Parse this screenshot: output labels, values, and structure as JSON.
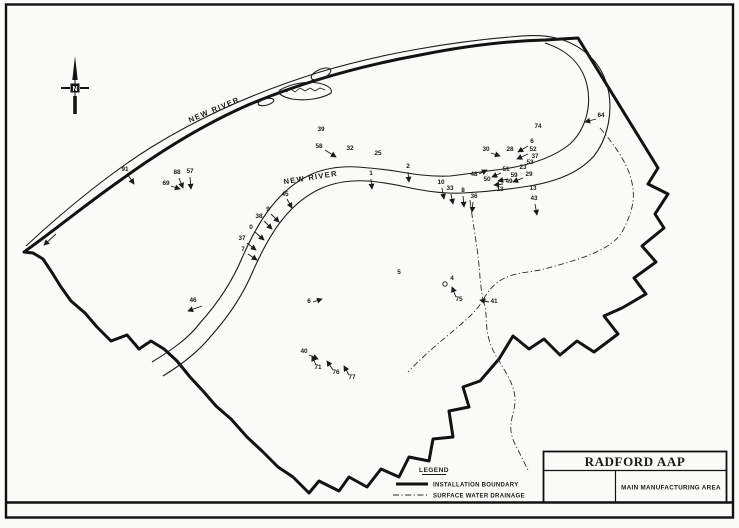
{
  "page": {
    "bg": "#fafaf8",
    "ink": "#1b1b1b"
  },
  "north_arrow": {
    "label": "N"
  },
  "river_labels": [
    {
      "text": "NEW RIVER",
      "x": 215,
      "y": 112,
      "rotate": -23
    },
    {
      "text": "NEW RIVER",
      "x": 311,
      "y": 180,
      "rotate": -9
    }
  ],
  "legend": {
    "heading": "LEGEND",
    "items": [
      {
        "label": "INSTALLATION BOUNDARY",
        "style": "boundary"
      },
      {
        "label": "SURFACE WATER DRAINAGE",
        "style": "drainage"
      }
    ]
  },
  "title_block": {
    "title": "RADFORD AAP",
    "subtitle": "MAIN MANUFACTURING AREA"
  },
  "sites": [
    {
      "n": "91",
      "x": 125,
      "y": 171,
      "a": [
        128,
        175,
        134,
        184
      ]
    },
    {
      "n": "69",
      "x": 166,
      "y": 185,
      "a": [
        171,
        186,
        180,
        189
      ]
    },
    {
      "n": "88",
      "x": 177,
      "y": 174,
      "a": [
        179,
        178,
        183,
        188
      ]
    },
    {
      "n": "57",
      "x": 190,
      "y": 173,
      "a": [
        190,
        177,
        191,
        189
      ]
    },
    {
      "n": "39",
      "x": 321,
      "y": 131
    },
    {
      "n": "58",
      "x": 319,
      "y": 148,
      "a": [
        325,
        150,
        336,
        157
      ]
    },
    {
      "n": "32",
      "x": 350,
      "y": 150
    },
    {
      "n": "25",
      "x": 378,
      "y": 155
    },
    {
      "n": "45",
      "x": 285,
      "y": 196,
      "a": [
        287,
        199,
        292,
        208
      ]
    },
    {
      "n": "9",
      "x": 268,
      "y": 211,
      "a": [
        271,
        214,
        279,
        222
      ]
    },
    {
      "n": "38",
      "x": 259,
      "y": 218,
      "a": [
        264,
        221,
        272,
        229
      ]
    },
    {
      "n": "0",
      "x": 251,
      "y": 229,
      "a": [
        255,
        232,
        264,
        240
      ]
    },
    {
      "n": "37",
      "x": 242,
      "y": 240,
      "a": [
        247,
        243,
        256,
        250
      ]
    },
    {
      "n": "7",
      "x": 243,
      "y": 251,
      "a": [
        248,
        254,
        257,
        260
      ]
    },
    {
      "n": "1",
      "x": 371,
      "y": 175,
      "a": [
        371,
        179,
        372,
        189
      ]
    },
    {
      "n": "2",
      "x": 408,
      "y": 168,
      "a": [
        408,
        172,
        409,
        182
      ]
    },
    {
      "n": "10",
      "x": 441,
      "y": 184,
      "a": [
        442,
        188,
        444,
        199
      ]
    },
    {
      "n": "33",
      "x": 450,
      "y": 190,
      "a": [
        451,
        194,
        453,
        204
      ]
    },
    {
      "n": "8",
      "x": 463,
      "y": 192,
      "a": [
        463,
        196,
        464,
        207
      ]
    },
    {
      "n": "36",
      "x": 474,
      "y": 198,
      "a": [
        473,
        202,
        472,
        212
      ]
    },
    {
      "n": "43",
      "x": 534,
      "y": 200,
      "a": [
        535,
        204,
        537,
        215
      ]
    },
    {
      "n": "13",
      "x": 500,
      "y": 191
    },
    {
      "n": "13",
      "x": 533,
      "y": 190
    },
    {
      "n": "74",
      "x": 538,
      "y": 128
    },
    {
      "n": "64",
      "x": 601,
      "y": 117,
      "a": [
        596,
        119,
        585,
        122
      ]
    },
    {
      "n": "30",
      "x": 486,
      "y": 151,
      "a": [
        491,
        153,
        500,
        156
      ]
    },
    {
      "n": "28",
      "x": 510,
      "y": 151
    },
    {
      "n": "6",
      "x": 532,
      "y": 143,
      "a": [
        528,
        146,
        518,
        152
      ]
    },
    {
      "n": "52",
      "x": 533,
      "y": 151,
      "a": [
        528,
        154,
        517,
        159
      ]
    },
    {
      "n": "37",
      "x": 535,
      "y": 158
    },
    {
      "n": "53",
      "x": 530,
      "y": 164
    },
    {
      "n": "23",
      "x": 523,
      "y": 169
    },
    {
      "n": "51",
      "x": 506,
      "y": 171,
      "a": [
        501,
        173,
        492,
        177
      ]
    },
    {
      "n": "59",
      "x": 514,
      "y": 177,
      "a": [
        508,
        179,
        498,
        181
      ]
    },
    {
      "n": "49",
      "x": 509,
      "y": 183,
      "a": [
        503,
        184,
        494,
        185
      ]
    },
    {
      "n": "29",
      "x": 529,
      "y": 176,
      "a": [
        523,
        178,
        513,
        182
      ]
    },
    {
      "n": "48",
      "x": 474,
      "y": 176,
      "a": [
        479,
        174,
        487,
        170
      ]
    },
    {
      "n": "50",
      "x": 487,
      "y": 181
    },
    {
      "n": "46",
      "x": 193,
      "y": 302,
      "a": [
        202,
        306,
        188,
        311
      ]
    },
    {
      "n": "5",
      "x": 399,
      "y": 274
    },
    {
      "n": "6",
      "x": 309,
      "y": 303,
      "a": [
        313,
        302,
        322,
        299
      ]
    },
    {
      "n": "4",
      "x": 452,
      "y": 280
    },
    {
      "n": "75",
      "x": 459,
      "y": 301,
      "a": [
        456,
        297,
        452,
        287
      ]
    },
    {
      "n": "41",
      "x": 494,
      "y": 303,
      "a": [
        489,
        302,
        480,
        300
      ]
    },
    {
      "n": "40",
      "x": 304,
      "y": 353,
      "a": [
        309,
        355,
        318,
        359
      ]
    },
    {
      "n": "71",
      "x": 318,
      "y": 369,
      "a": [
        316,
        365,
        312,
        356
      ]
    },
    {
      "n": "76",
      "x": 336,
      "y": 374,
      "a": [
        333,
        370,
        327,
        361
      ]
    },
    {
      "n": "77",
      "x": 352,
      "y": 379,
      "a": [
        349,
        375,
        344,
        366
      ]
    }
  ]
}
